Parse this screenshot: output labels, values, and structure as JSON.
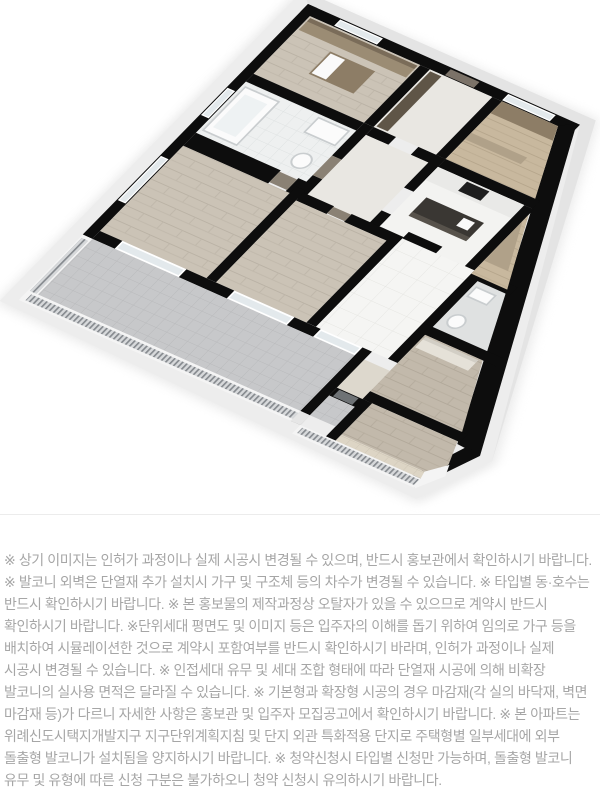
{
  "floorplan": {
    "type": "isometric-3d-unit-floorplan",
    "colors": {
      "wall_cut": "#0d0d0d",
      "parapet_white": "#f4f4f4",
      "plinth": "#ededed",
      "wood_floor": "#cbc3b6",
      "wood_floor_dark": "#c2b9ab",
      "tan_wood": "#c8b89e",
      "white_tile": "#f4f4f2",
      "terrace_tile": "#c7c8ca",
      "bath_tile": "#eef0f0",
      "island_top": "#3a3733",
      "door_brown": "#8a8174",
      "door_gray": "#6e7275",
      "railing": "#85898e",
      "glass": "#e3e9ec"
    }
  },
  "disclaimer": {
    "text": "※ 상기 이미지는 인허가 과정이나 실제 시공시 변경될 수 있으며, 반드시 홍보관에서 확인하시기 바랍니다. ※ 발코니 외벽은 단열재 추가 설치시 가구 및 구조체 등의 차수가 변경될 수 있습니다. ※ 타입별 동·호수는 반드시 확인하시기 바랍니다. ※ 본 홍보물의 제작과정상 오탈자가 있을 수 있으므로 계약시 반드시 확인하시기 바랍니다. ※단위세대 평면도 및 이미지 등은 입주자의 이해를 돕기 위하여 임의로 가구 등을 배치하여 시뮬레이션한 것으로 계약시 포함여부를 반드시 확인하시기 바라며, 인허가 과정이나 실제 시공시 변경될 수 있습니다. ※ 인접세대 유무 및 세대 조합 형태에 따라 단열재 시공에 의해 비확장 발코니의 실사용 면적은 달라질 수 있습니다. ※ 기본형과 확장형 시공의 경우 마감재(각 실의 바닥재, 벽면 마감재 등)가 다르니 자세한 사항은 홍보관 및 입주자 모집공고에서 확인하시기 바랍니다. ※ 본 아파트는 위례신도시택지개발지구 지구단위계획지침 및 단지 외관 특화적용 단지로 주택형별 일부세대에 외부 돌출형 발코니가 설치됨을 양지하시기 바랍니다. ※ 청약신청시 타입별 신청만 가능하며, 돌출형 발코니 유무 및 유형에 따른 신청 구분은 불가하오니 청약 신청시 유의하시기 바랍니다."
  }
}
